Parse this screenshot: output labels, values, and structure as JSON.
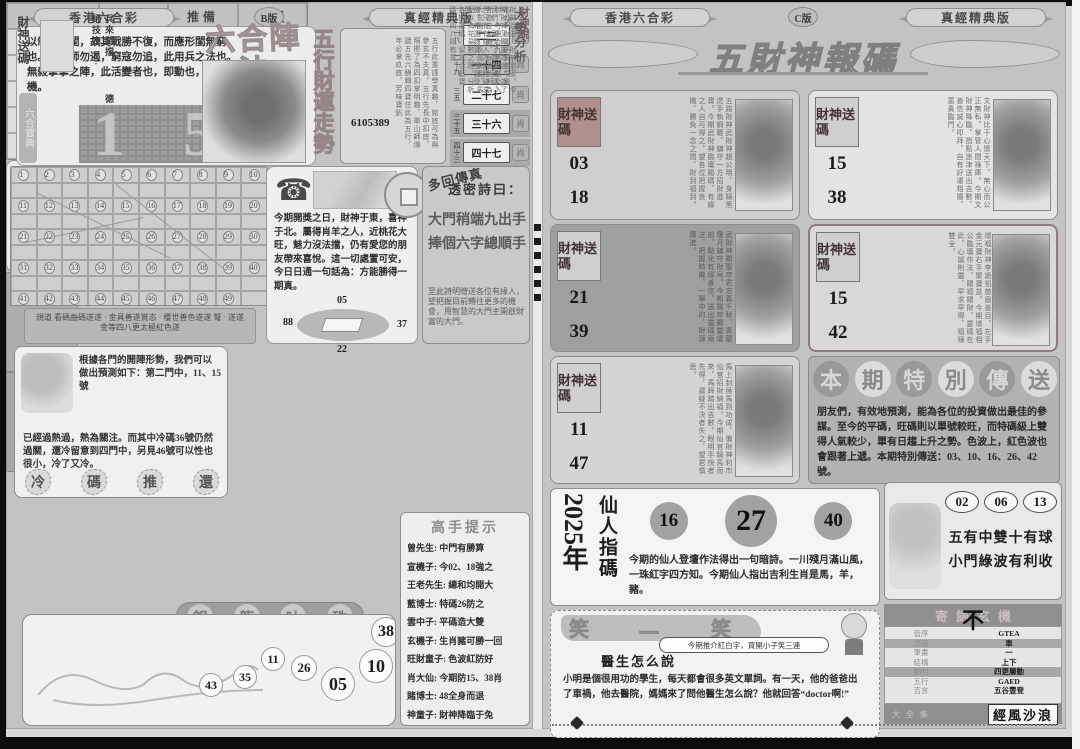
{
  "left_page": {
    "header": {
      "brand": "香港六合彩",
      "edition": "B版",
      "version": "真經精典版"
    },
    "intro_text": "以制勝之閨，故其戰勝不復，而應形閨無窮也。其歸師勿遏，窮寇勿追，此用兵之法也。無殺掌掌之陣，此活變者也，即動也，悟出玄機。",
    "side_tab": "六合寶典",
    "big_digit_1": "1",
    "big_digit_2": "5",
    "main_title": "六合陣法",
    "fortune_title": "五行財運走勢",
    "fortune_poem": "五行此重謹學真趣，銘底可為與參玄不夫真，五行先長中扣底，照擦了為四扣掌明趣，單山師傳遞五先六酬轉四寶住此為五行，年必掌玖底，芳味寶釩",
    "fortune_phone": "6105389",
    "pairs": [
      {
        "k": "一八",
        "v": "二三"
      },
      {
        "k": "二十九",
        "v": "一十四"
      },
      {
        "k": "三五",
        "v": "二十七"
      },
      {
        "k": "三十五",
        "v": "三十六"
      },
      {
        "k": "四十三",
        "v": "四十七"
      }
    ],
    "grid": {
      "rows": [
        [
          "1",
          "2",
          "3",
          "4",
          "5",
          "6",
          "7",
          "8",
          "9",
          "10"
        ],
        [
          "11",
          "12",
          "13",
          "14",
          "15",
          "16",
          "17",
          "18",
          "19",
          "20"
        ],
        [
          "21",
          "22",
          "23",
          "24",
          "25",
          "26",
          "27",
          "28",
          "29",
          "30"
        ],
        [
          "31",
          "32",
          "33",
          "34",
          "35",
          "36",
          "37",
          "38",
          "39",
          "40"
        ],
        [
          "41",
          "42",
          "43",
          "44",
          "45",
          "46",
          "47",
          "48",
          "49",
          ""
        ]
      ]
    },
    "grid_caption": "規道 看碼曲碼遂遂 · 金具善遂賞态 · 樱世善色遂遂 弩 · 遂遂金等四八更太極紅色遂",
    "talk": {
      "text": "今期開獎之日，財神于東，喜神于北。屬得肖羊之人，近桃花大旺，魅力沒法擋，仍有愛您的朋友帶來喜悅。這一切處置可安，今日日通一句話為：方能勝得一期真。",
      "n_top": "05",
      "n_left": "88",
      "n_right": "37",
      "n_bottom": "22"
    },
    "secret": {
      "badge": "多回傳真",
      "title": "透密詩曰：",
      "line1": "大門稍端九出手",
      "line2": "捧個六字總順手",
      "note": "至此詩明贈送各位有緣人，望把握目前轉往更多的機會，用智慧的大門主開啟財富的大門。"
    },
    "predict": {
      "text1": "根據各門的開陣形勢，我們可以做出預測如下：第二門中，11、15號",
      "text2": "已經過熱過，熱為關注。而其中冷碼36號仍然過關，還冷留意到四門中，另見46號可以性也很小，冷了又冷。",
      "words": [
        "冷",
        "碼",
        "推",
        "還"
      ]
    },
    "table": {
      "headers": [
        "門類",
        "推曉",
        "推備",
        "推慢"
      ],
      "rows": [
        [
          "第一門 1 至 9",
          "08",
          "01",
          "02"
        ],
        [
          "第二門 10 至 19",
          "18",
          "10",
          "13"
        ],
        [
          "第三門 20 至 29",
          "29",
          "20",
          "25"
        ],
        [
          "第四門 30 至 39",
          "36",
          "31",
          "33"
        ],
        [
          "第五門 40 至 49",
          "48",
          "40",
          "42"
        ]
      ]
    },
    "caishen_card": {
      "label": "財神送碼",
      "phrase1": "兵來將擋 ·",
      "phrase2": "德絕技四 ·"
    },
    "caishen_talk": {
      "title": "財神說",
      "text": "財神說法，財神到家。今期財神又顯靈為過，為了民們，親悅了魏位藏碼，但只有有緣人才能勝破玄機，希遂魏寶，祝您發財。"
    },
    "trend": {
      "title": "大勢分析",
      "text": "本公司財運研究各項資料，考慮合九宮神數及入會遊位玄機，直通世術為人玄機子，長遠來看，馬配以梅花易數之理，分析各期運碼，留意合藍寶碼，四八四有意。"
    },
    "tips": {
      "title": "高手提示",
      "lines": [
        "曾先生: 中門有勝算",
        "宣機子: 今02、18強之",
        "王老先生: 總和均開大",
        "藍博士: 特碼26防之",
        "雲中子: 平碼造大雙",
        "玄機子: 生肖豬可勝一回",
        "旺財童子: 色波紅防好",
        "肖大仙: 今期防15、38肖",
        "賭博士: 48全身而退",
        "神童子: 財神降臨于兔"
      ]
    },
    "dragon": {
      "title_chars": [
        "銀",
        "龍",
        "吐",
        "珠"
      ],
      "numbers": [
        "43",
        "35",
        "11",
        "26",
        "05",
        "10",
        "38"
      ]
    }
  },
  "right_page": {
    "header": {
      "brand": "香港六合彩",
      "edition": "C版",
      "version": "真經精典版"
    },
    "banner": "五財神報碼",
    "card_label": "財神送碼",
    "cards": [
      {
        "n1": "03",
        "n2": "18",
        "text": "五路財神武財神趙公明，身騎黑虎手執鋼鞭，鎮守一方招財進寶。今期武財神臨壇賜碼，有緣之人自可得之，望各位把握良機，勝負一念之間，財到福到。"
      },
      {
        "n1": "15",
        "n2": "38",
        "text": "文財神比干心懷天下，無心而公正無私，掌管人間祿庫。今期文財神降臨，指點迷津送出吉數，善信誠心叩拜，自有好運相隨，富貴臨門。"
      },
      {
        "n1": "21",
        "n2": "39",
        "text": "武財神關聖帝君忠義千秋，青龍偃月鎮守財帛。今期關帝顯靈壇前，點化有緣善信，送出靈碼兩注，把握時機，一舉中的，財源廣進。"
      },
      {
        "n1": "15",
        "n2": "42",
        "text": "增福財神李詭祖慈眉善目，左手金元寶右手聚寶盆。今期增福相公臨壇作法，賜福賜財，靈碼在此，心誠則靈，早求早得，福祿雙全。"
      },
      {
        "n1": "11",
        "n2": "47",
        "text": "馬上封侯馬到功成，偏財神利市仙官招財納福。今期仙官騎馬而來，馬蹄踏出吉數，眼明手快者先得，遲疑不決者失之，望君慎思。"
      }
    ],
    "special": {
      "title": "本期特別傳送",
      "text": "朋友們，有效地預測，能為各位的投資做出最佳的參謀。至今的平碼，旺碼則以單號較旺，而特碼級上雙得人氣較少，單有日趨上升之勢。色波上，紅色波也會跟著上遞。本期特別傳送：03、10、16、26、42號。"
    },
    "immortal": {
      "title": "仙人指碼",
      "year": "2025年",
      "numbers": [
        "16",
        "27",
        "40"
      ],
      "text": "今期的仙人登壇作法得出一句暗詩。一川殘月滿山風，一珠紅字四方知。今期仙人指出吉利生肖是馬，羊，豬。"
    },
    "lucky": {
      "numbers": [
        "02",
        "06",
        "13"
      ],
      "line1": "五有中雙十有球",
      "line2": "小門綠波有利收"
    },
    "riddle": {
      "banner": "寄語玄機",
      "character": "不",
      "rows": [
        [
          "音序",
          "GTEA"
        ],
        [
          "部首",
          "車"
        ],
        [
          "筆畫",
          "一"
        ],
        [
          "結構",
          "上下"
        ],
        [
          "動向",
          "四更層動"
        ],
        [
          "五行",
          "GAED"
        ],
        [
          "吉言",
          "五谷豐登"
        ]
      ],
      "foot_faint": "大全集",
      "foot_box": "經風沙浪"
    },
    "joke": {
      "banner_chars": [
        "笑",
        "一",
        "笑"
      ],
      "title": "醫生怎么說",
      "bubble": "今期推介紅白字，買開小子笑三連",
      "text": "小明是個很用功的學生，每天都會很多英文單詞。有一天，他的爸爸出了車禍，他去醫院，媽媽來了問他醫生怎么說？他就回答“doctor啊!”"
    }
  }
}
